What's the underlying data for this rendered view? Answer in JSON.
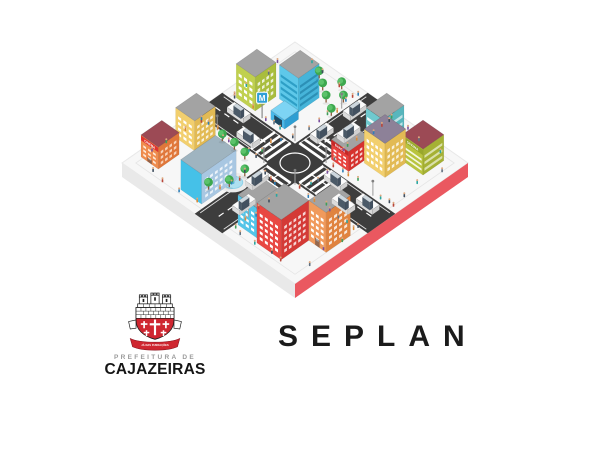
{
  "org": {
    "name": "SEPLAN"
  },
  "logo": {
    "prefeitura": "PREFEITURA DE",
    "city": "CAJAZEIRAS",
    "motto": "JÁ NAS FUNDAÇÕES"
  },
  "illustration": {
    "signs": {
      "cinema": "CINEMA",
      "banco": "BANCO",
      "oficina": "OFICINA",
      "metro": "M"
    },
    "colors": {
      "platform_top": "#f7f7f7",
      "platform_left": "#e9e9e9",
      "platform_right": "#ea5860",
      "road": "#3d3d3d",
      "marking": "#ffffff",
      "lime": "#c0d04f",
      "lime_d": "#a9bd3d",
      "sky": "#5ec8e9",
      "sky_d": "#46b4d9",
      "sky_win": "#2e9fc6",
      "teal": "#6fc9ce",
      "teal_d": "#58b6bd",
      "yellow": "#f2cf6e",
      "yellow_d": "#e2ba54",
      "cinema": "#ef8c4e",
      "cinema_d": "#e0773a",
      "sign_cinema": "#e0342f",
      "banco": "#e8433e",
      "banco_d": "#d6322e",
      "sign_banco": "#c62828",
      "olive": "#b9c43e",
      "olive_d": "#a5b134",
      "sign_olive": "#99a72c",
      "periwinkle": "#a8c7e2",
      "cyan_end": "#45c1e8",
      "cyan_b": "#54c5e8",
      "cyan_b_d": "#3cb1d9",
      "red_b": "#e84843",
      "red_b_d": "#d43a36",
      "orange_b": "#f09a5c",
      "orange_b_d": "#e0833f",
      "roof_gray": "#a3a3a3",
      "roof_maroon": "#9c4a55",
      "roof_purple": "#8d8198",
      "tree": "#3da84e",
      "tree_light": "#5cc26b",
      "trunk": "#8a5a3b",
      "fountain": "#aee0f0",
      "metro": "#2f9fd8",
      "canopy": "#49b8e8",
      "canopy_d": "#2e9ed2",
      "canopy_top": "#7dd4f4",
      "logo_red": "#cf2630",
      "text_dark": "#1b1b1b",
      "text_gray": "#9a9a9a"
    }
  }
}
